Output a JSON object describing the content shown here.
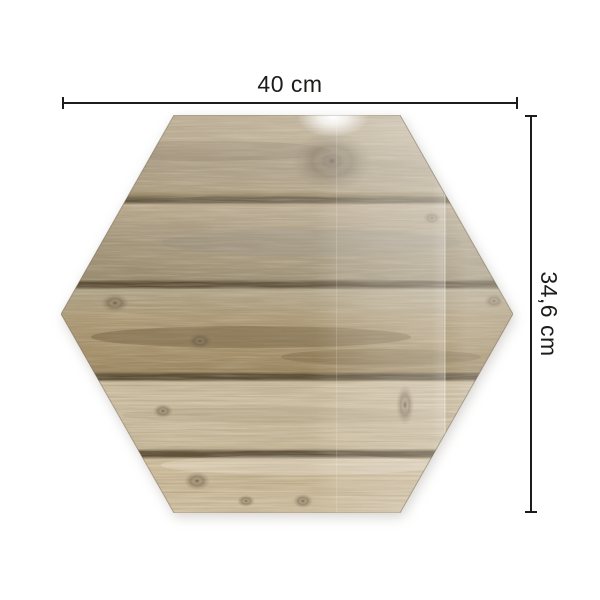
{
  "product": {
    "name": "hexagon wood-plank panel",
    "shape": "hexagon",
    "surface": "wood planks",
    "plank_count": 5
  },
  "dimensions": {
    "width_label": "40 cm",
    "height_label": "34,6 cm"
  },
  "colors": {
    "background": "#ffffff",
    "dimension_line": "#1c1c1a",
    "plank1": "#b1a081",
    "plank2": "#a89a80",
    "plank3": "#b19d79",
    "plank4": "#d5c7ab",
    "plank5": "#d1bf9f",
    "plank_gap": "#564832",
    "gloss": "#ffffff"
  }
}
